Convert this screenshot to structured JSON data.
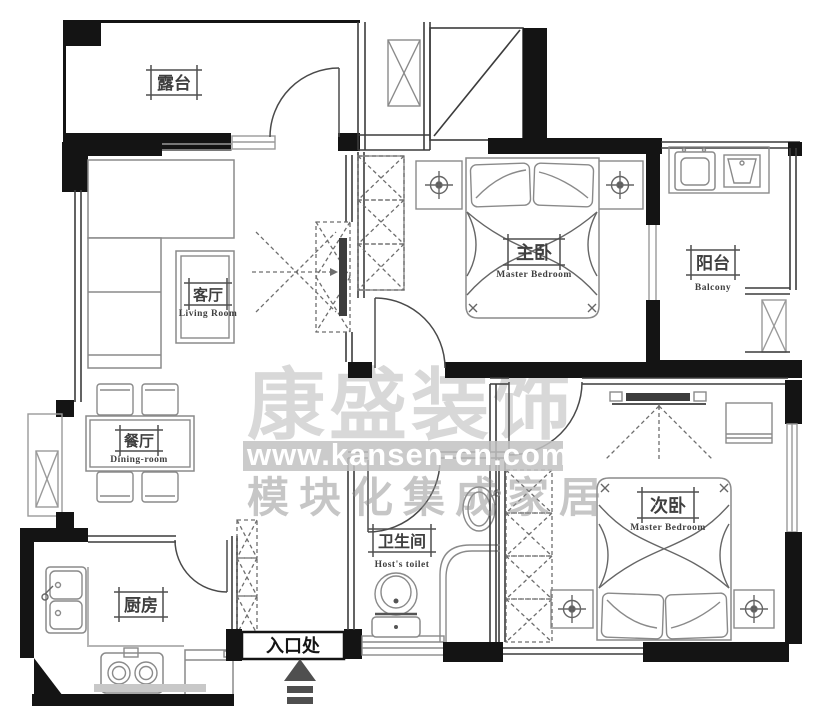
{
  "plan_title": "apartment-floor-plan",
  "colors": {
    "wall": "#141414",
    "thin_wall": "#3c3c3c",
    "window": "#9a9a9a",
    "furniture": "#8a8a8a",
    "watermark_band": "#c2c2c2",
    "watermark_text": "#8f8f8f"
  },
  "rooms": {
    "terrace": {
      "cn": "露台",
      "en": ""
    },
    "living": {
      "cn": "客厅",
      "en": "Living Room"
    },
    "dining": {
      "cn": "餐厅",
      "en": "Dining-room"
    },
    "master": {
      "cn": "主卧",
      "en": "Master Bedroom"
    },
    "balcony": {
      "cn": "阳台",
      "en": "Balcony"
    },
    "second": {
      "cn": "次卧",
      "en": "Master Bedroom"
    },
    "bathroom": {
      "cn": "卫生间",
      "en": "Host's toilet"
    },
    "kitchen": {
      "cn": "厨房",
      "en": ""
    },
    "entrance": {
      "cn": "入口处",
      "en": ""
    }
  },
  "watermark": {
    "line1": "康盛装饰",
    "line2": "www.kansen-cn.com",
    "line3": "模块化集成家居"
  }
}
